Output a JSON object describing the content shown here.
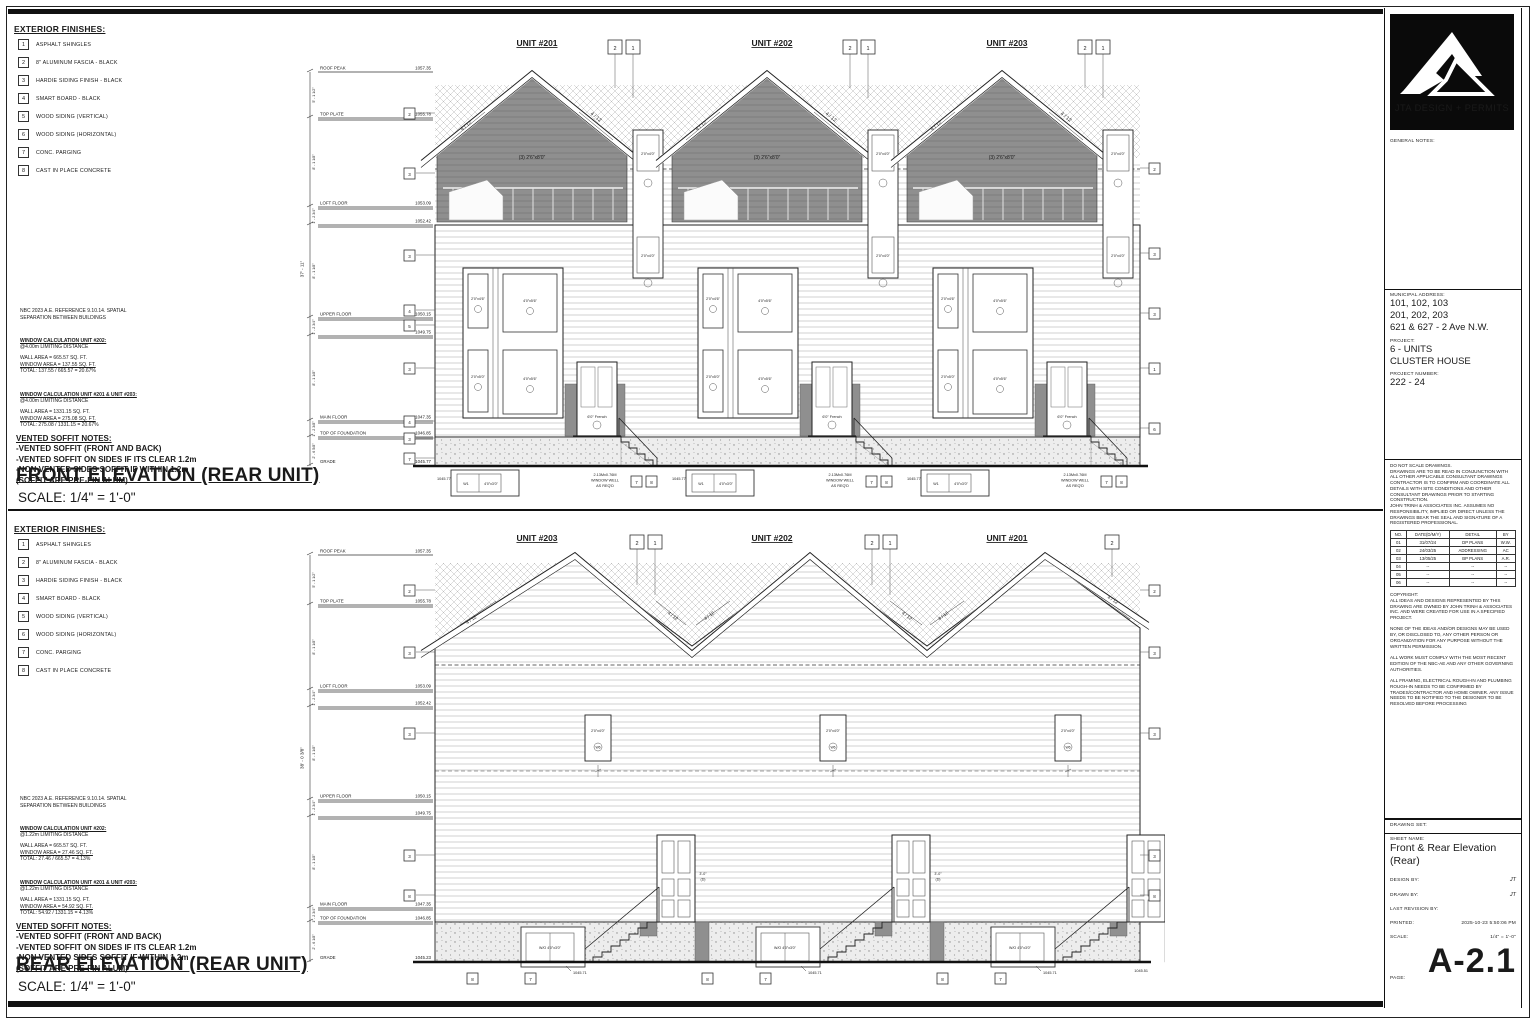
{
  "colors": {
    "ink": "#1a1a1a",
    "gable_fill": "#8f8f8f",
    "siding_line": "#c7c7c7",
    "concrete_bg": "#ededed",
    "logo_bg": "#0a0a0a"
  },
  "legend": {
    "title": "EXTERIOR FINISHES:",
    "items": [
      {
        "no": "1",
        "label": "ASPHALT SHINGLES"
      },
      {
        "no": "2",
        "label": "8\" ALUMINUM FASCIA - BLACK"
      },
      {
        "no": "3",
        "label": "HARDIE SIDING FINISH - BLACK"
      },
      {
        "no": "4",
        "label": "SMART BOARD - BLACK"
      },
      {
        "no": "5",
        "label": "WOOD SIDING (VERTICAL)"
      },
      {
        "no": "6",
        "label": "WOOD SIDING (HORIZONTAL)"
      },
      {
        "no": "7",
        "label": "CONC. PARGING"
      },
      {
        "no": "8",
        "label": "CAST IN PLACE CONCRETE"
      }
    ]
  },
  "shared_notes": {
    "nbc_line1": "NBC 2023 A.E. REFERENCE 9.10.14. SPATIAL",
    "nbc_line2": "SEPARATION BETWEEN BUILDINGS",
    "soffit_title": "VENTED SOFFIT NOTES:",
    "soffit_l1": "-VENTED SOFFIT (FRONT AND BACK)",
    "soffit_l2": "-VENTED SOFFIT ON SIDES IF ITS CLEAR 1.2m",
    "soffit_l3": "-NON VENTED SIDES SOFFIT IF WITHIN 1.2m",
    "soffit_l4": "(SOFFIT ARE PRE-FIN ALUM)"
  },
  "front_panel": {
    "calc1": {
      "title": "WINDOW CALCULATION UNIT #202:",
      "sub": "@4.00m LIMITING DISTANCE",
      "l1": "WALL AREA = 665.57 SQ. FT.",
      "l2": "WINDOW AREA = 137.55 SQ. FT.",
      "l3": "TOTAL: 137.55 / 665.57 = 20.67%"
    },
    "calc2": {
      "title": "WINDOW CALCULATION UNIT #201 & UNIT #203:",
      "sub": "@4.00m LIMITING DISTANCE",
      "l1": "WALL AREA = 1331.15 SQ. FT.",
      "l2": "WINDOW AREA = 275.08 SQ. FT.",
      "l3": "TOTAL: 275.08 / 1331.15 = 20.67%"
    },
    "title": "FRONT ELEVATION (REAR UNIT)",
    "scale": "SCALE: 1/4\" = 1'-0\"",
    "units": [
      "UNIT #201",
      "UNIT #202",
      "UNIT #203"
    ],
    "slope": "4 / 12",
    "levels": [
      {
        "name": "ROOF PEAK",
        "val": "1057.35"
      },
      {
        "name": "TOP PLATE",
        "val": "1055.78"
      },
      {
        "name": "LOFT FLOOR",
        "val": "1053.09"
      },
      {
        "name": "",
        "val": "1052.42"
      },
      {
        "name": "UPPER FLOOR",
        "val": "1050.15"
      },
      {
        "name": "",
        "val": "1049.75"
      },
      {
        "name": "MAIN FLOOR",
        "val": "1047.35"
      },
      {
        "name": "TOP OF FOUNDATION",
        "val": "1046.85"
      },
      {
        "name": "GRADE",
        "val": "1045.77"
      }
    ],
    "overall_dim": "37' - 11\"",
    "dims": [
      "5' - 1 1/2\"",
      "8' - 1 1/8\"",
      "1' - 2 3/4\"",
      "8' - 1 1/8\"",
      "1' - 2 3/4\"",
      "8' - 1 1/8\"",
      "1' - 2 3/8\"",
      "2' - 6 5/8\""
    ],
    "left_keys": [
      "2",
      "3",
      "3",
      "4",
      "5",
      "3",
      "4",
      "3",
      "7"
    ],
    "right_keys": [
      "2",
      "3",
      "3",
      "1",
      "6"
    ],
    "top_key_a": "2",
    "top_key_b": "1",
    "bottom_key_a": "7",
    "bottom_key_b": "8",
    "tags": {
      "gable": "(3) 2'6\"x8'0\"",
      "side": "2'0\"x4'0\"",
      "small_top": "2'0\"x4'6\"",
      "small_bot": "2'0\"x5'0\"",
      "large_top": "4'0\"x5'6\"",
      "large_bot": "4'0\"x5'6\"",
      "door": "6'0\" French",
      "well_id": "W1",
      "well": "4'0\"x3'0\"",
      "spot": "1045.77"
    },
    "well_note1": "2.13Mx0.76M",
    "well_note2": "WINDOW WELL",
    "well_note3": "AS REQ'D"
  },
  "rear_panel": {
    "calc1": {
      "title": "WINDOW CALCULATION UNIT #202:",
      "sub": "@1.22m LIMITING DISTANCE",
      "l1": "WALL AREA = 665.57 SQ. FT.",
      "l2": "WINDOW AREA = 27.46 SQ. FT.",
      "l3": "TOTAL: 27.46 / 665.57 = 4.13%"
    },
    "calc2": {
      "title": "WINDOW CALCULATION UNIT #201 & UNIT #203:",
      "sub": "@1.22m LIMITING DISTANCE",
      "l1": "WALL AREA = 1331.15 SQ. FT.",
      "l2": "WINDOW AREA = 54.92 SQ. FT.",
      "l3": "TOTAL: 54.92 / 1331.15 = 4.13%"
    },
    "title": "REAR ELEVATION (REAR UNIT)",
    "scale": "SCALE: 1/4\" = 1'-0\"",
    "units": [
      "UNIT #203",
      "UNIT #202",
      "UNIT #201"
    ],
    "slope": "4 / 12",
    "levels": [
      {
        "name": "ROOF PEAK",
        "val": "1057.35"
      },
      {
        "name": "TOP PLATE",
        "val": "1055.78"
      },
      {
        "name": "LOFT FLOOR",
        "val": "1053.09"
      },
      {
        "name": "",
        "val": "1052.42"
      },
      {
        "name": "UPPER FLOOR",
        "val": "1050.15"
      },
      {
        "name": "",
        "val": "1049.75"
      },
      {
        "name": "MAIN FLOOR",
        "val": "1047.35"
      },
      {
        "name": "TOP OF FOUNDATION",
        "val": "1046.85"
      },
      {
        "name": "GRADE",
        "val": "1045.23"
      }
    ],
    "overall_dim": "38' - 0 3/8\"",
    "dims": [
      "5' - 1 1/2\"",
      "8' - 1 1/8\"",
      "1' - 2 3/4\"",
      "8' - 1 1/8\"",
      "1' - 2 3/4\"",
      "8' - 1 1/8\"",
      "1' - 2 3/4\"",
      "2' - 6 1/8\""
    ],
    "left_keys": [
      "2",
      "3",
      "3",
      "3",
      "8"
    ],
    "right_keys": [
      "2",
      "3",
      "3",
      "3",
      "8"
    ],
    "top_key_a": "2",
    "top_key_b": "1",
    "bottom_key_a": "8",
    "bottom_key_b": "7",
    "tags": {
      "loft": "2'0\"x4'0\"",
      "loft_id": "W6",
      "door": "3'-0\"",
      "door_id": "(D)",
      "basement": "W/O 4'0\"x3'0\"",
      "spot": "1045.71",
      "spot_right": "1045.51"
    }
  },
  "titleblock": {
    "logo_text": "JTA DESIGN + PERMITS",
    "general_notes_label": "GENERAL NOTES:",
    "address_label": "MUNICIPAL ADDRESS:",
    "address1": "101, 102, 103",
    "address2": "201, 202, 203",
    "address3": "621 & 627 - 2 Ave N.W.",
    "project_label": "PROJECT:",
    "project1": "6 - UNITS",
    "project2": "CLUSTER HOUSE",
    "project_number_label": "PROJECT NUMBER:",
    "project_number": "222 - 24",
    "disclaimer": "DO NOT SCALE DRAWINGS.\nDRAWINGS ARE TO BE READ IN CONJUNCTION WITH ALL OTHER APPLICABLE CONSULTANT DRAWINGS CONTRACTOR IS TO CONFIRM AND COORDINATE ALL DETAILS WITH SITE CONDITIONS AND OTHER CONSULTANT DRAWINGS PRIOR TO STARTING CONSTRUCTION.\nJOHN TRINH & ASSOCIATES INC. ASSUMES NO RESPONSIBILITY, IMPLIED OR DIRECT UNLESS THE DRAWINGS BEAR THE SEAL AND SIGNATURE OF A REGISTERED PROFESSIONAL.",
    "rev_headers": [
      "NO.",
      "DATE(D/M/Y)",
      "DETAIL",
      "BY"
    ],
    "rev_rows": [
      [
        "01",
        "31/07/24",
        "DP PLANS",
        "W.W."
      ],
      [
        "02",
        "24/03/25",
        "ADDRESSING",
        "AC"
      ],
      [
        "03",
        "13/05/25",
        "BP PLANS",
        "A.R."
      ],
      [
        "04",
        "--",
        "--",
        "--"
      ],
      [
        "05",
        "--",
        "--",
        "--"
      ],
      [
        "06",
        "--",
        "--",
        "--"
      ]
    ],
    "copyright": "COPYRIGHT:\nALL IDEAS AND DESIGNS REPRESENTED BY THIS DRAWING ARE OWNED BY JOHN TRINH & ASSOCIATES INC. AND WERE CREATED FOR USE IN A SPECIFIED PROJECT.\n\nNONE OF THE IDEAS AND/OR DESIGNS MAY BE USED BY, OR DISCLOSED TO, ANY OTHER PERSON OR ORGANIZATION FOR ANY PURPOSE WITHOUT THE WRITTEN PERMISSION.\n\nALL WORK MUST COMPLY WITH THE MOST RECENT EDITION OF THE NBC-AE AND ANY OTHER GOVERNING AUTHORITIES.\n\nALL FRAMING, ELECTRICAL ROUGH-IN AND PLUMBING ROUGH-IN NEEDS TO BE CONFIRMED BY TRADES/CONTRACTOR AND HOME OWNER. ANY ISSUE NEEDS TO BE NOTIFIED TO THE DESIGNER TO BE RESOLVED BEFORE PROCESSING",
    "drawing_set_label": "DRAWING SET:",
    "sheet_name_label": "SHEET NAME:",
    "sheet_name1": "Front & Rear Elevation",
    "sheet_name2": "(Rear)",
    "design_by_label": "DESIGN BY:",
    "design_by": "JT",
    "drawn_by_label": "DRAWN BY:",
    "drawn_by": "JT",
    "last_revision_label": "LAST REVISION BY:",
    "printed_label": "PRINTED:",
    "printed": "2025-10-23 5:50:06 PM",
    "scale_label": "SCALE:",
    "scale": "1/4\" = 1'-0\"",
    "page_label": "PAGE:",
    "page": "A-2.1"
  }
}
